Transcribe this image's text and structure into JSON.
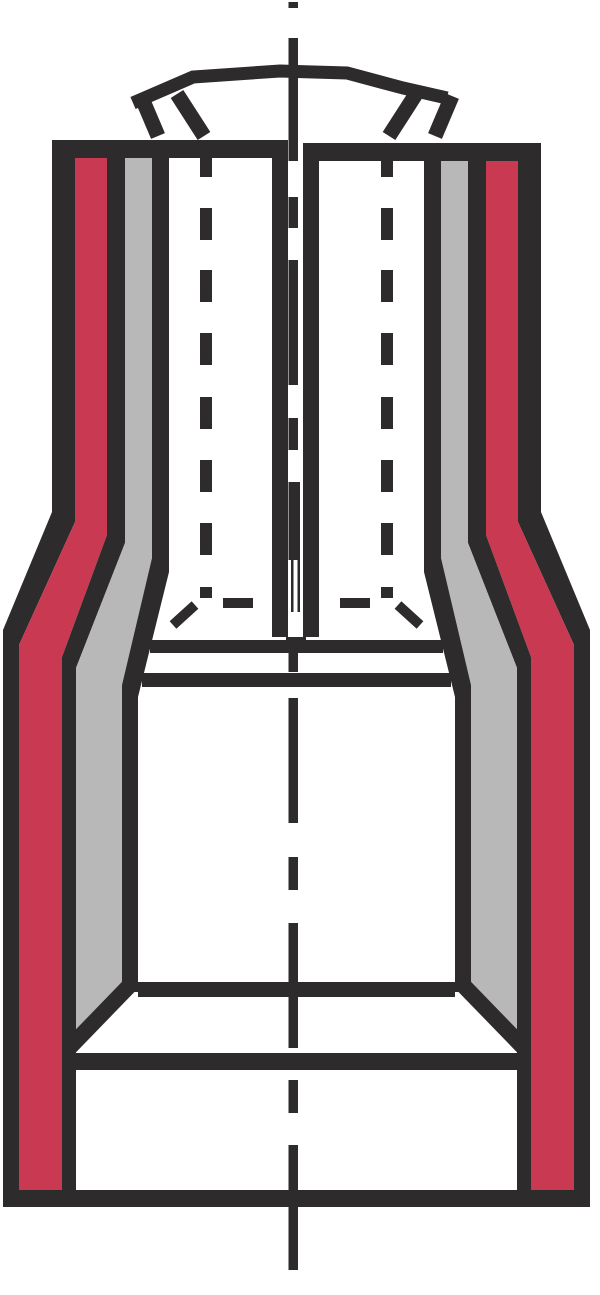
{
  "figure": {
    "kind": "technical-cross-section-drawing",
    "subject": "fully-insulated-flat-receptacle-terminal"
  },
  "canvas": {
    "width": 600,
    "height": 1295
  },
  "colors": {
    "background": "#ffffff",
    "outline": "#2d2b2c",
    "insulation_red": "#c93a52",
    "metal_gray": "#b8b8b8"
  }
}
